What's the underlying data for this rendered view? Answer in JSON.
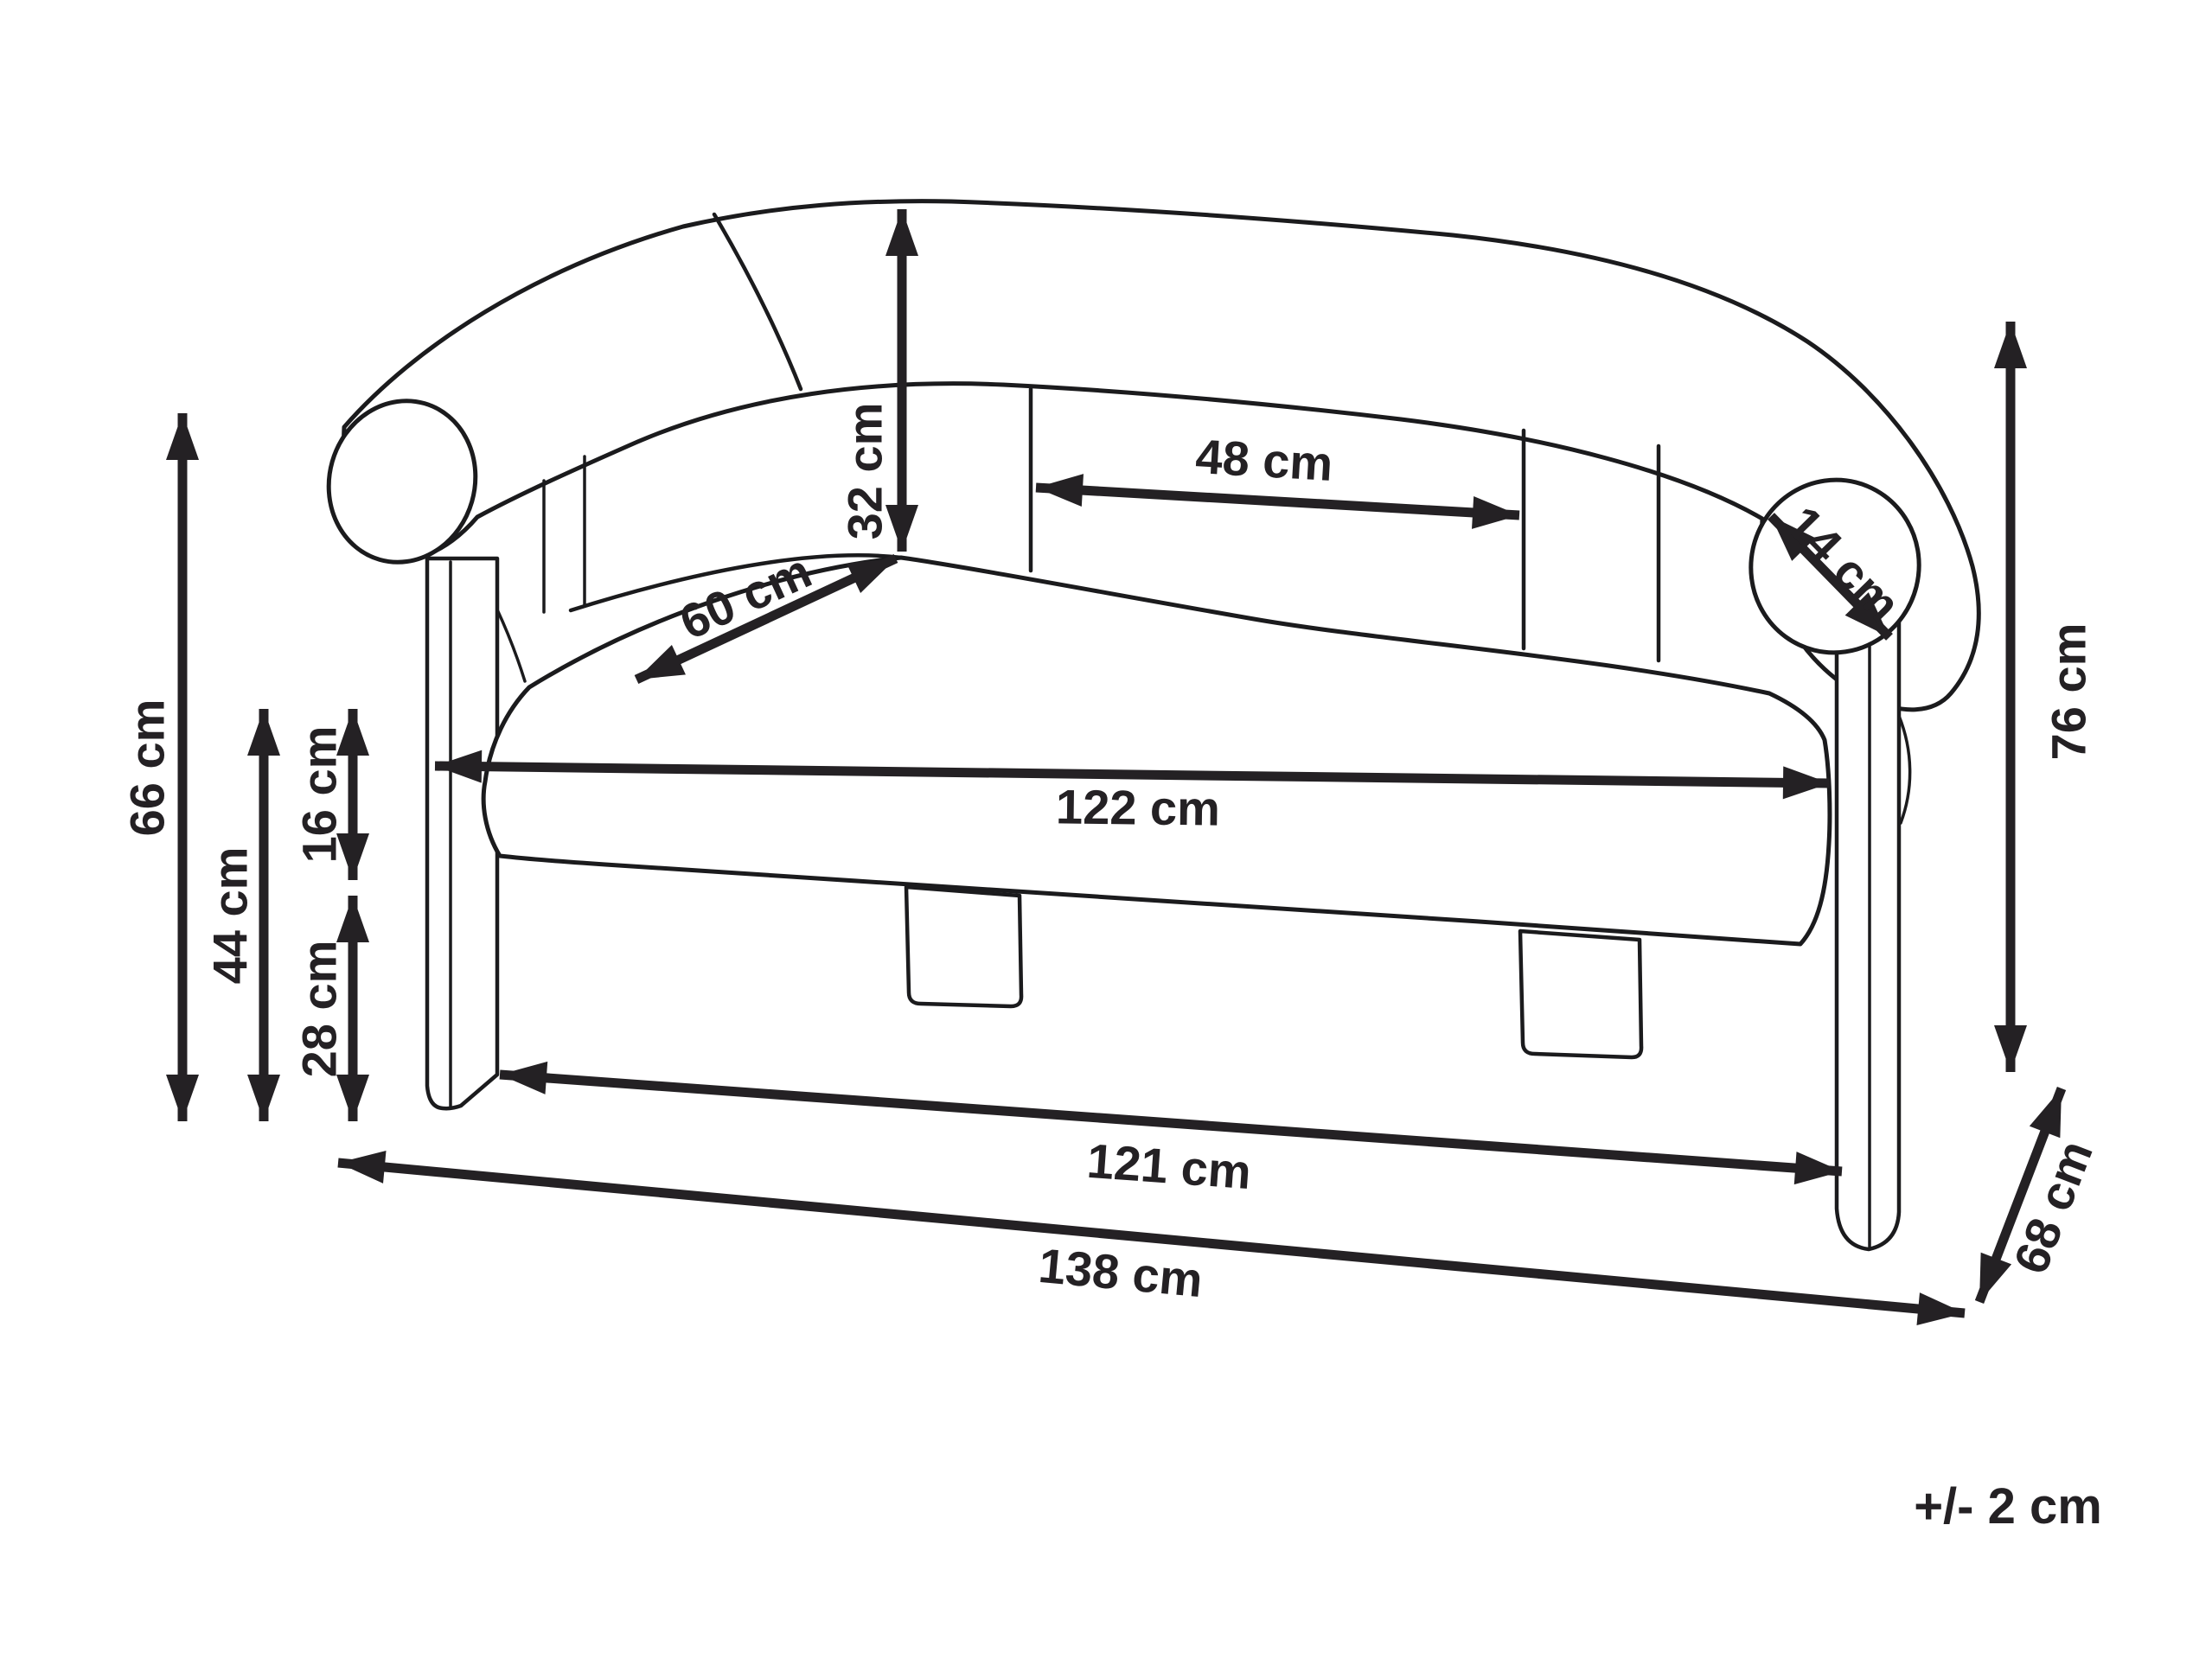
{
  "colors": {
    "ink": "#242124",
    "outline": "#1b1b1d",
    "background": "#ffffff"
  },
  "units": "cm",
  "labels": {
    "back_height": "32 cm",
    "back_section_width": "48 cm",
    "seat_depth": "60 cm",
    "armrest_diameter": "14 cm",
    "seat_width": "122 cm",
    "backrest_height": "66 cm",
    "seat_height": "44 cm",
    "seat_thickness": "16 cm",
    "underseat_clearance": "28 cm",
    "base_width": "121 cm",
    "overall_width": "138 cm",
    "overall_height": "76 cm",
    "overall_depth": "68 cm",
    "tolerance": "+/- 2 cm"
  }
}
